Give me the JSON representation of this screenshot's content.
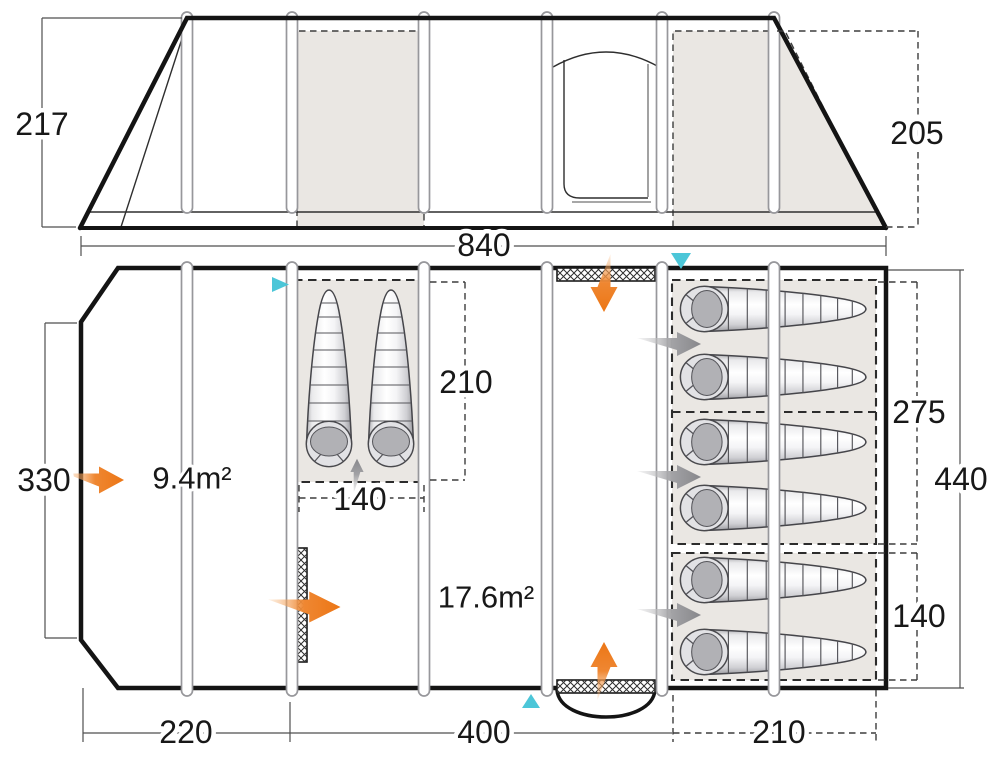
{
  "diagram": {
    "side_view": {
      "height_front": "217",
      "height_rear": "205",
      "length": "840"
    },
    "floor_plan": {
      "width": "330",
      "sections": {
        "porch": "220",
        "living": "400",
        "bedroom": "210"
      },
      "left_pod": {
        "length": "210",
        "width": "140"
      },
      "right_bedroom": {
        "main_width": "275",
        "small_width": "140",
        "total_depth": "440"
      },
      "areas": {
        "porch": "9.4m²",
        "living": "17.6m²"
      }
    }
  },
  "colors": {
    "accent_orange": "#EE7F27",
    "vent_cyan": "#4CC6D8",
    "panel_shade": "#EAE7E3",
    "arrow_gray": "#8C8C90",
    "line_dark": "#181818"
  }
}
